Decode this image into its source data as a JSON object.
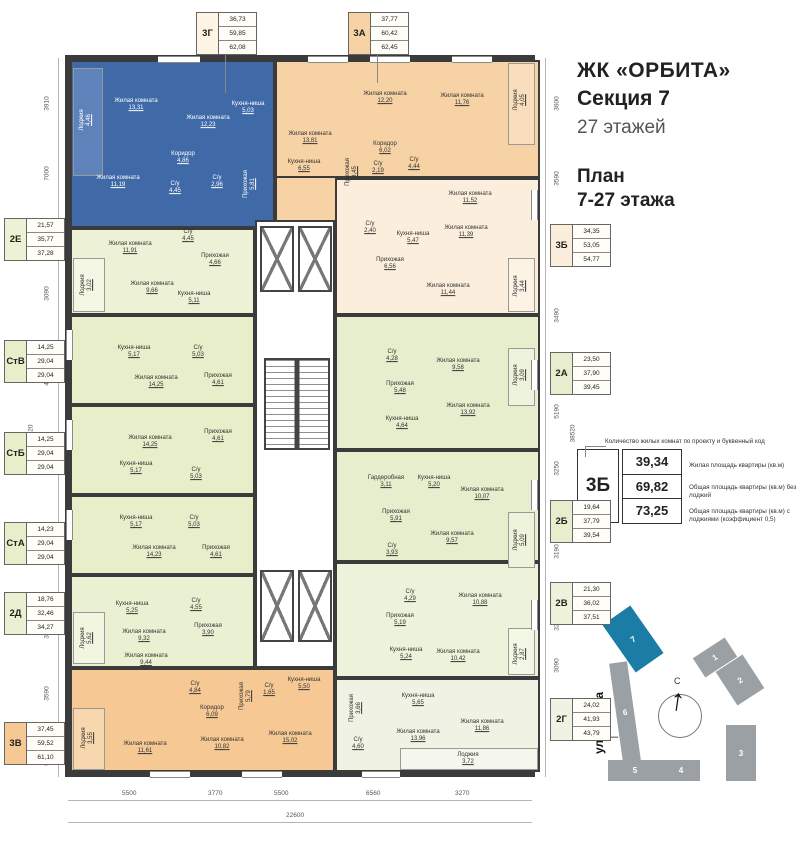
{
  "title": {
    "project": "ЖК «ОРБИТА»",
    "section": "Секция 7",
    "floors": "27 этажей",
    "plan1": "План",
    "plan2": "7-27 этажа"
  },
  "legend": {
    "callout": "Количество жилых комнат по проекту и буквенный код",
    "code": "3Б",
    "rows": [
      {
        "value": "39,34",
        "desc": "Жилая площадь квартиры (кв.м)"
      },
      {
        "value": "69,82",
        "desc": "Общая площадь квартиры (кв.м) без лоджий"
      },
      {
        "value": "73,25",
        "desc": "Общая площадь квартиры (кв.м) с лоджиями (коэффициент 0,5)"
      }
    ]
  },
  "site": {
    "street": "ул. Титова",
    "north": "С",
    "sections": [
      "1",
      "2",
      "3",
      "4",
      "5",
      "6",
      "7"
    ]
  },
  "dims": {
    "left": [
      "3910",
      "7000",
      "3090",
      "4650",
      "4650",
      "4650",
      "3850",
      "3590",
      "5190"
    ],
    "right": [
      "3600",
      "3590",
      "3650",
      "3490",
      "5190",
      "3250",
      "3190",
      "3250",
      "3090",
      "4970"
    ],
    "bottom": [
      "5500",
      "3770",
      "5500",
      "6560",
      "3270"
    ],
    "total_height": "38520",
    "total_width": "22600"
  },
  "apartments": [
    {
      "code": "3Г",
      "values": [
        "36,73",
        "59,85",
        "62,08"
      ],
      "rooms": [
        {
          "name": "Лоджия",
          "area": "4,46"
        },
        {
          "name": "Жилая комната",
          "area": "13,31"
        },
        {
          "name": "Жилая комната",
          "area": "12,23"
        },
        {
          "name": "Кухня-ниша",
          "area": "5,03"
        },
        {
          "name": "Жилая комната",
          "area": "11,19"
        },
        {
          "name": "Коридор",
          "area": "4,86"
        },
        {
          "name": "С/у",
          "area": "4,45"
        },
        {
          "name": "С/у",
          "area": "2,96"
        },
        {
          "name": "Прихожая",
          "area": "5,81"
        }
      ]
    },
    {
      "code": "3А",
      "values": [
        "37,77",
        "60,42",
        "62,45"
      ],
      "rooms": [
        {
          "name": "Жилая комната",
          "area": "13,81"
        },
        {
          "name": "Кухня-ниша",
          "area": "6,55"
        },
        {
          "name": "Жилая комната",
          "area": "12,20"
        },
        {
          "name": "Жилая комната",
          "area": "11,76"
        },
        {
          "name": "Лоджия",
          "area": "4,05"
        },
        {
          "name": "Коридор",
          "area": "6,02"
        },
        {
          "name": "Прихожая",
          "area": "3,45"
        },
        {
          "name": "С/у",
          "area": "2,19"
        },
        {
          "name": "С/у",
          "area": "4,44"
        }
      ]
    },
    {
      "code": "3Б",
      "values": [
        "34,35",
        "53,05",
        "54,77"
      ],
      "rooms": [
        {
          "name": "Жилая комната",
          "area": "11,52"
        },
        {
          "name": "Жилая комната",
          "area": "11,39"
        },
        {
          "name": "С/у",
          "area": "2,40"
        },
        {
          "name": "Кухня-ниша",
          "area": "5,47"
        },
        {
          "name": "Прихожая",
          "area": "6,56"
        },
        {
          "name": "Жилая комната",
          "area": "11,44"
        },
        {
          "name": "Лоджия",
          "area": "3,44"
        }
      ]
    },
    {
      "code": "2Е",
      "values": [
        "21,57",
        "35,77",
        "37,28"
      ],
      "rooms": [
        {
          "name": "Жилая комната",
          "area": "11,91"
        },
        {
          "name": "С/у",
          "area": "4,45"
        },
        {
          "name": "Прихожая",
          "area": "4,66"
        },
        {
          "name": "Лоджия",
          "area": "3,02"
        },
        {
          "name": "Жилая комната",
          "area": "9,66"
        },
        {
          "name": "Кухня-ниша",
          "area": "5,11"
        }
      ]
    },
    {
      "code": "СтВ",
      "values": [
        "14,25",
        "29,04",
        "29,04"
      ],
      "rooms": [
        {
          "name": "Кухня-ниша",
          "area": "5,17"
        },
        {
          "name": "С/у",
          "area": "5,03"
        },
        {
          "name": "Жилая комната",
          "area": "14,25"
        },
        {
          "name": "Прихожая",
          "area": "4,61"
        }
      ]
    },
    {
      "code": "СтБ",
      "values": [
        "14,25",
        "29,04",
        "29,04"
      ],
      "rooms": [
        {
          "name": "Жилая комната",
          "area": "14,25"
        },
        {
          "name": "Прихожая",
          "area": "4,61"
        },
        {
          "name": "Кухня-ниша",
          "area": "5,17"
        },
        {
          "name": "С/у",
          "area": "5,03"
        }
      ]
    },
    {
      "code": "СтА",
      "values": [
        "14,23",
        "29,04",
        "29,04"
      ],
      "rooms": [
        {
          "name": "Кухня-ниша",
          "area": "5,17"
        },
        {
          "name": "С/у",
          "area": "5,03"
        },
        {
          "name": "Жилая комната",
          "area": "14,23"
        },
        {
          "name": "Прихожая",
          "area": "4,61"
        }
      ]
    },
    {
      "code": "2Д",
      "values": [
        "18,76",
        "32,46",
        "34,27"
      ],
      "rooms": [
        {
          "name": "Кухня-ниша",
          "area": "5,25"
        },
        {
          "name": "С/у",
          "area": "4,55"
        },
        {
          "name": "Жилая комната",
          "area": "9,32"
        },
        {
          "name": "Прихожая",
          "area": "3,90"
        },
        {
          "name": "Лоджия",
          "area": "5,62"
        },
        {
          "name": "Жилая комната",
          "area": "9,44"
        }
      ]
    },
    {
      "code": "3В",
      "values": [
        "37,45",
        "59,52",
        "61,10"
      ],
      "rooms": [
        {
          "name": "С/у",
          "area": "4,84"
        },
        {
          "name": "Коридор",
          "area": "6,09"
        },
        {
          "name": "Прихожая",
          "area": "5,79"
        },
        {
          "name": "С/у",
          "area": "1,65"
        },
        {
          "name": "Кухня-ниша",
          "area": "5,50"
        },
        {
          "name": "Жилая комната",
          "area": "15,02"
        },
        {
          "name": "Жилая комната",
          "area": "10,82"
        },
        {
          "name": "Жилая комната",
          "area": "11,61"
        },
        {
          "name": "Лоджия",
          "area": "3,55"
        }
      ]
    },
    {
      "code": "2А",
      "values": [
        "23,50",
        "37,90",
        "39,45"
      ],
      "rooms": [
        {
          "name": "С/у",
          "area": "4,28"
        },
        {
          "name": "Прихожая",
          "area": "5,48"
        },
        {
          "name": "Кухня-ниша",
          "area": "4,64"
        },
        {
          "name": "Жилая комната",
          "area": "9,58"
        },
        {
          "name": "Лоджия",
          "area": "3,09"
        },
        {
          "name": "Жилая комната",
          "area": "13,92"
        }
      ]
    },
    {
      "code": "2Б",
      "values": [
        "19,64",
        "37,79",
        "39,54"
      ],
      "rooms": [
        {
          "name": "Гардеробная",
          "area": "3,11"
        },
        {
          "name": "Кухня-ниша",
          "area": "5,20"
        },
        {
          "name": "Жилая комната",
          "area": "10,07"
        },
        {
          "name": "Прихожая",
          "area": "5,91"
        },
        {
          "name": "Жилая комната",
          "area": "9,57"
        },
        {
          "name": "С/у",
          "area": "3,93"
        },
        {
          "name": "Лоджия",
          "area": "5,09"
        }
      ]
    },
    {
      "code": "2В",
      "values": [
        "21,30",
        "36,02",
        "37,51"
      ],
      "rooms": [
        {
          "name": "С/у",
          "area": "4,29"
        },
        {
          "name": "Жилая комната",
          "area": "10,88"
        },
        {
          "name": "Прихожая",
          "area": "5,19"
        },
        {
          "name": "Кухня-ниша",
          "area": "5,24"
        },
        {
          "name": "Жилая комната",
          "area": "10,42"
        },
        {
          "name": "Лоджия",
          "area": "2,87"
        }
      ]
    },
    {
      "code": "2Г",
      "values": [
        "24,02",
        "41,93",
        "43,79"
      ],
      "rooms": [
        {
          "name": "Прихожая",
          "area": "3,66"
        },
        {
          "name": "С/у",
          "area": "4,60"
        },
        {
          "name": "Кухня-ниша",
          "area": "5,65"
        },
        {
          "name": "Жилая комната",
          "area": "13,96"
        },
        {
          "name": "Жилая комната",
          "area": "11,86"
        },
        {
          "name": "Лоджия",
          "area": "3,72"
        }
      ]
    }
  ]
}
